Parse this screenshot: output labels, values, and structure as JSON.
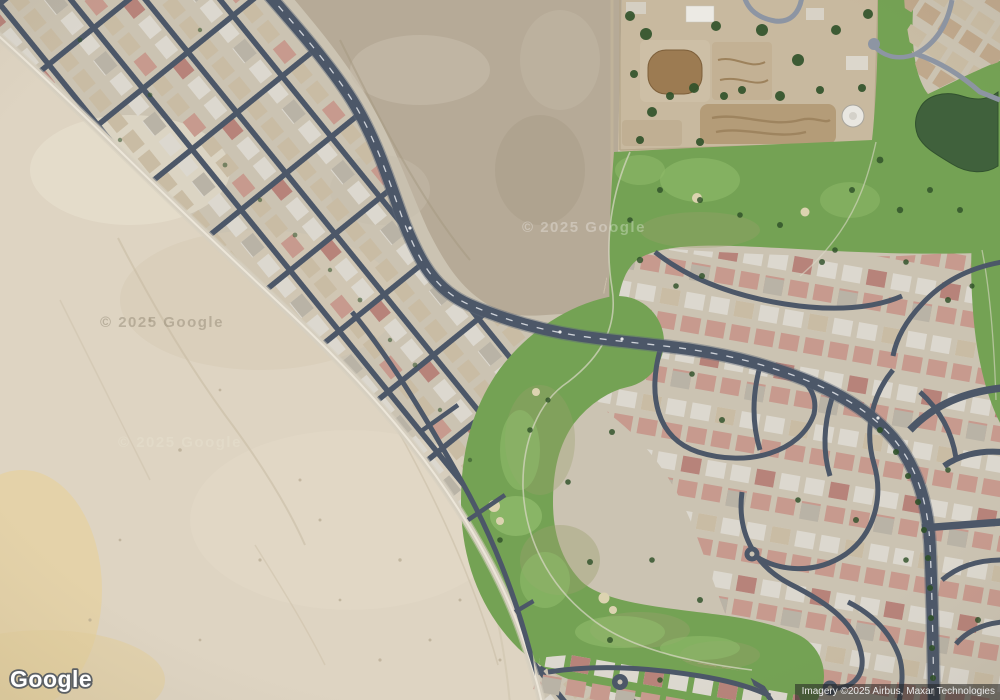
{
  "map": {
    "type": "satellite",
    "provider_logo": "Google",
    "attribution": "Imagery ©2025 Airbus, Maxar Technologies",
    "watermarks": [
      "© 2025 Google",
      "© 2025 Google",
      "© 2025 Google"
    ]
  },
  "colors": {
    "ground": "#cbc3b2",
    "sand": "#ded4c2",
    "sandLight": "#eae2d2",
    "sandYellow": "#e6d2a0",
    "dirt": "#b6aa97",
    "dirtLight": "#c6bcab",
    "ranch": "#c8b99f",
    "arena": "#9c7b52",
    "road": "#4c5768",
    "roadLight": "#8d95a3",
    "roadPale": "#d6cfc0",
    "roadLine": "#dde0e5",
    "green": "#74a254",
    "greenLight": "#8fba6a",
    "greenOlive": "#9aa06d",
    "treeGreen": "#2f5129",
    "pond": "#40613c",
    "houseLight": "#dcd8cf",
    "houseGray": "#b9b3a6",
    "houseTan": "#c9bca4",
    "houseRed": "#b7837a",
    "housePink": "#c79a8e",
    "houseBrown": "#bfa88c",
    "bunker": "#dcd3b0",
    "tank": "#e9e7e1",
    "attributionBg": "rgba(32,32,32,0.55)",
    "attributionText": "#e9e9e9",
    "logoFill": "#ffffff",
    "logoOutline": "#5c6064"
  }
}
